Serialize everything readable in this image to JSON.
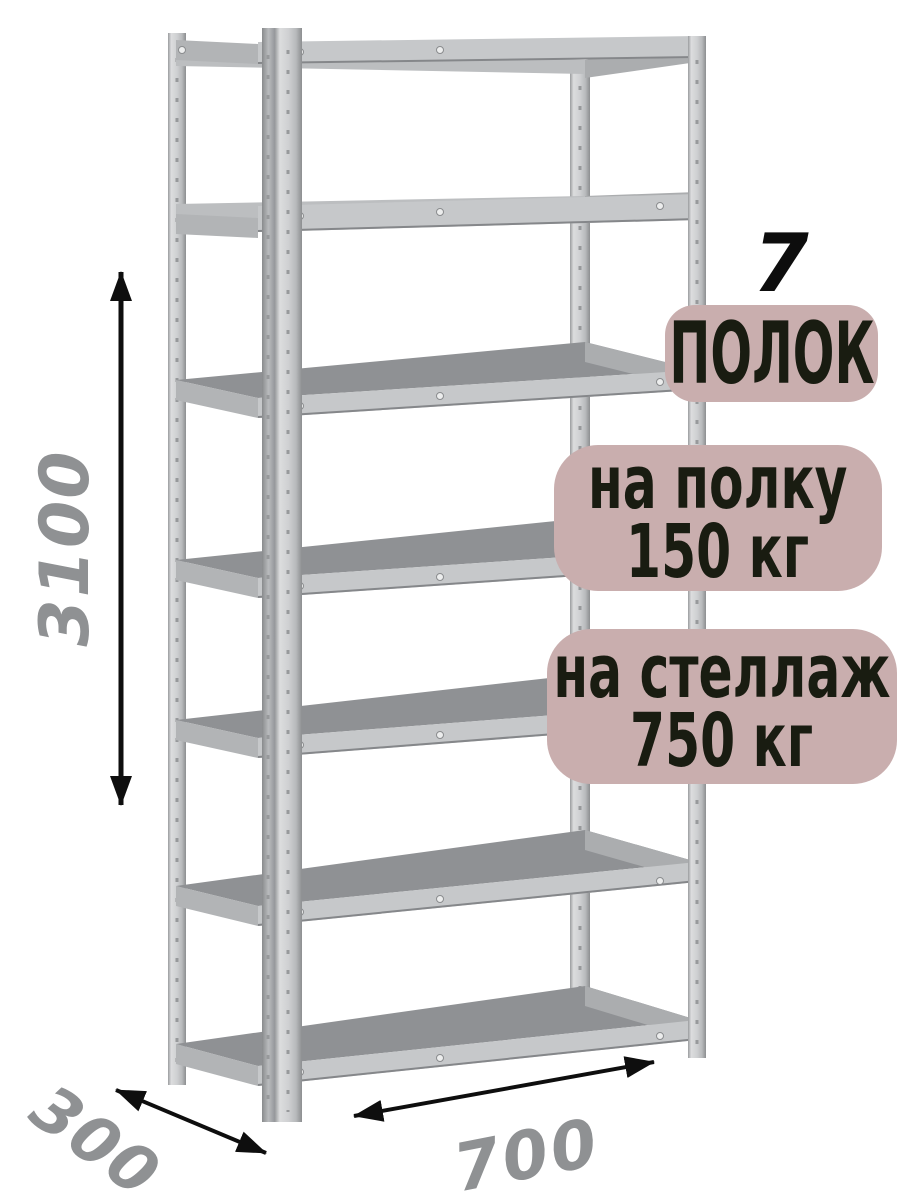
{
  "callouts": {
    "shelf_count": {
      "number": "7",
      "label": "ПОЛОК"
    },
    "per_shelf_load": {
      "line1": "на полку",
      "line2": "150 кг"
    },
    "per_rack_load": {
      "line1": "на стеллаж",
      "line2": "750 кг"
    }
  },
  "dimensions": {
    "height": {
      "value": "3100"
    },
    "depth": {
      "value": "300"
    },
    "width": {
      "value": "700"
    }
  },
  "icons": {
    "height_arrow": "double-headed-vertical-arrow",
    "depth_arrow": "double-headed-diagonal-arrow",
    "width_arrow": "double-headed-diagonal-arrow"
  },
  "colors": {
    "background": "#ffffff",
    "badge_bg": "#c9aeae",
    "badge_text": "#191c11",
    "shelf_count_text": "#0d0d0d",
    "dimension_text": "#8f9193",
    "arrow": "#0e0e0e",
    "shelf_surface": "#8f9194",
    "shelf_beam": "#c6c8ca",
    "shelf_beam_edge": "#85878a",
    "side_beam": "#b2b4b6",
    "hole": "#97999b"
  }
}
